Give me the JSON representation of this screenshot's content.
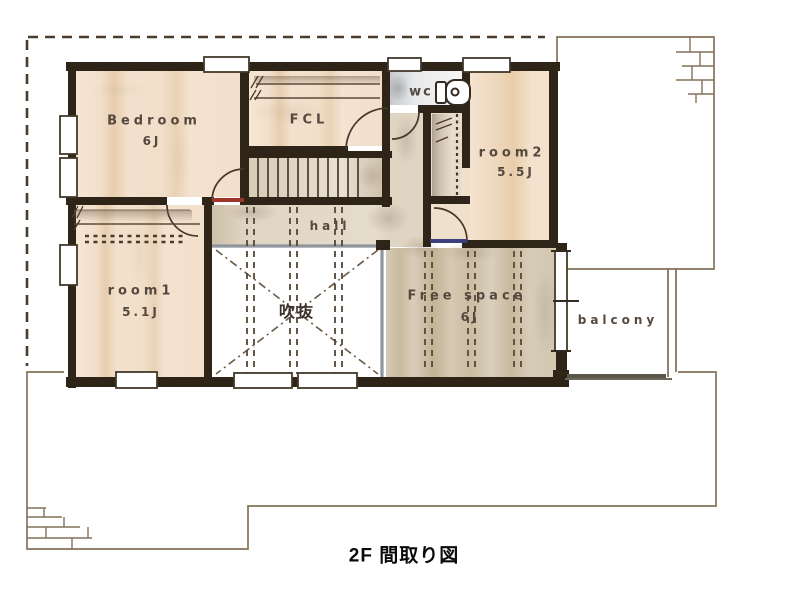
{
  "caption": "2F 間取り図",
  "rooms": {
    "bedroom": {
      "label": "Bedroom",
      "size": "6J"
    },
    "fcl": {
      "label": "FCL"
    },
    "wc": {
      "label": "wc"
    },
    "room2": {
      "label": "room2",
      "size": "5.5J"
    },
    "room1": {
      "label": "room1",
      "size": "5.1J"
    },
    "hall": {
      "label": "hall"
    },
    "void": {
      "label": "吹抜"
    },
    "free_space": {
      "label": "Free space",
      "size": "6J"
    },
    "balcony": {
      "label": "balcony"
    }
  },
  "colors": {
    "wall": "#2f2418",
    "room_fill": "#f2e0cb",
    "free_space_fill": "#cfc2a8",
    "void_railing": "#8e959d",
    "threshold_red": "#9e3528",
    "threshold_blue": "#3c3f7e",
    "first_floor_outline": "#84715a",
    "roof_dashed_outline": "#4a3b2c"
  }
}
